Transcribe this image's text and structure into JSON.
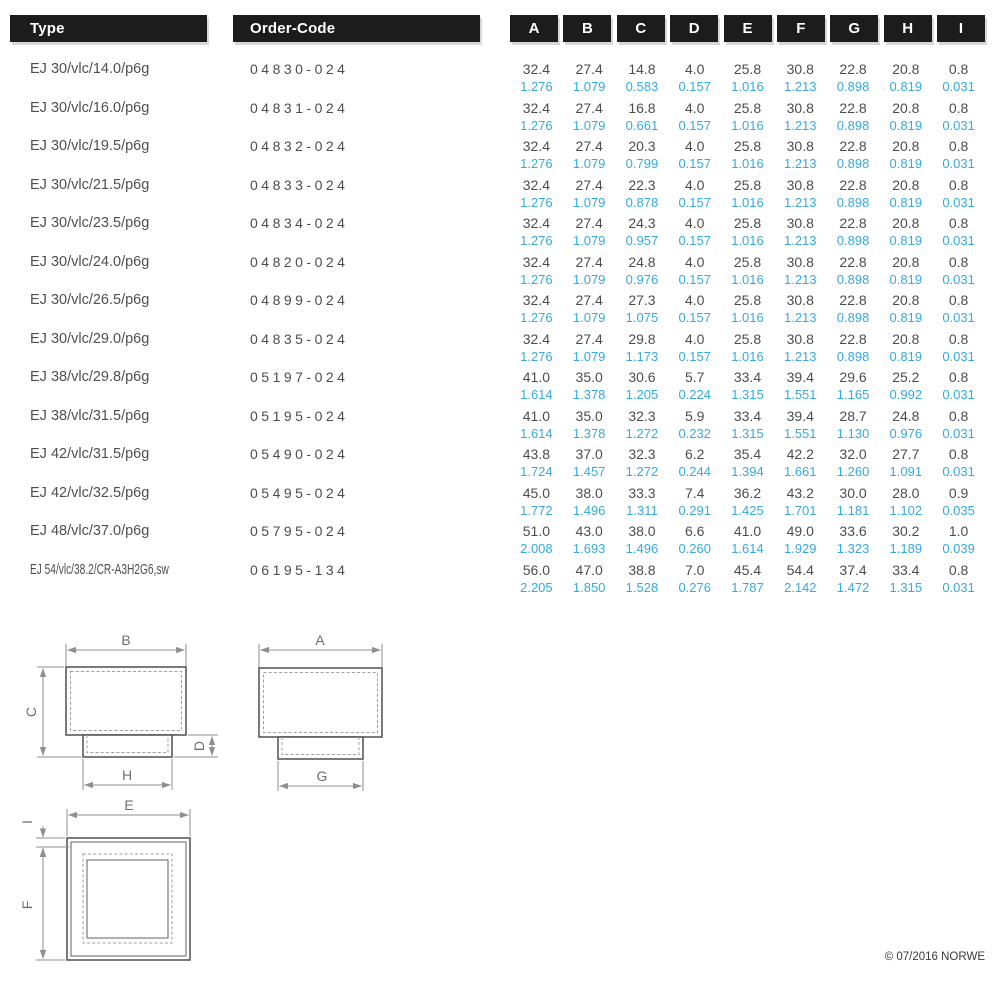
{
  "header": {
    "type_label": "Type",
    "order_code_label": "Order-Code",
    "dim_columns": [
      "A",
      "B",
      "C",
      "D",
      "E",
      "F",
      "G",
      "H",
      "I"
    ]
  },
  "rows": [
    {
      "type": "EJ 30/vlc/14.0/p6g",
      "order_code": "04830-024",
      "mm": [
        "32.4",
        "27.4",
        "14.8",
        "4.0",
        "25.8",
        "30.8",
        "22.8",
        "20.8",
        "0.8"
      ],
      "inch": [
        "1.276",
        "1.079",
        "0.583",
        "0.157",
        "1.016",
        "1.213",
        "0.898",
        "0.819",
        "0.031"
      ]
    },
    {
      "type": "EJ 30/vlc/16.0/p6g",
      "order_code": "04831-024",
      "mm": [
        "32.4",
        "27.4",
        "16.8",
        "4.0",
        "25.8",
        "30.8",
        "22.8",
        "20.8",
        "0.8"
      ],
      "inch": [
        "1.276",
        "1.079",
        "0.661",
        "0.157",
        "1.016",
        "1.213",
        "0.898",
        "0.819",
        "0.031"
      ]
    },
    {
      "type": "EJ 30/vlc/19.5/p6g",
      "order_code": "04832-024",
      "mm": [
        "32.4",
        "27.4",
        "20.3",
        "4.0",
        "25.8",
        "30.8",
        "22.8",
        "20.8",
        "0.8"
      ],
      "inch": [
        "1.276",
        "1.079",
        "0.799",
        "0.157",
        "1.016",
        "1.213",
        "0.898",
        "0.819",
        "0.031"
      ]
    },
    {
      "type": "EJ 30/vlc/21.5/p6g",
      "order_code": "04833-024",
      "mm": [
        "32.4",
        "27.4",
        "22.3",
        "4.0",
        "25.8",
        "30.8",
        "22.8",
        "20.8",
        "0.8"
      ],
      "inch": [
        "1.276",
        "1.079",
        "0.878",
        "0.157",
        "1.016",
        "1.213",
        "0.898",
        "0.819",
        "0.031"
      ]
    },
    {
      "type": "EJ 30/vlc/23.5/p6g",
      "order_code": "04834-024",
      "mm": [
        "32.4",
        "27.4",
        "24.3",
        "4.0",
        "25.8",
        "30.8",
        "22.8",
        "20.8",
        "0.8"
      ],
      "inch": [
        "1.276",
        "1.079",
        "0.957",
        "0.157",
        "1.016",
        "1.213",
        "0.898",
        "0.819",
        "0.031"
      ]
    },
    {
      "type": "EJ 30/vlc/24.0/p6g",
      "order_code": "04820-024",
      "mm": [
        "32.4",
        "27.4",
        "24.8",
        "4.0",
        "25.8",
        "30.8",
        "22.8",
        "20.8",
        "0.8"
      ],
      "inch": [
        "1.276",
        "1.079",
        "0.976",
        "0.157",
        "1.016",
        "1.213",
        "0.898",
        "0.819",
        "0.031"
      ]
    },
    {
      "type": "EJ 30/vlc/26.5/p6g",
      "order_code": "04899-024",
      "mm": [
        "32.4",
        "27.4",
        "27.3",
        "4.0",
        "25.8",
        "30.8",
        "22.8",
        "20.8",
        "0.8"
      ],
      "inch": [
        "1.276",
        "1.079",
        "1.075",
        "0.157",
        "1.016",
        "1.213",
        "0.898",
        "0.819",
        "0.031"
      ]
    },
    {
      "type": "EJ 30/vlc/29.0/p6g",
      "order_code": "04835-024",
      "mm": [
        "32.4",
        "27.4",
        "29.8",
        "4.0",
        "25.8",
        "30.8",
        "22.8",
        "20.8",
        "0.8"
      ],
      "inch": [
        "1.276",
        "1.079",
        "1.173",
        "0.157",
        "1.016",
        "1.213",
        "0.898",
        "0.819",
        "0.031"
      ]
    },
    {
      "type": "EJ 38/vlc/29.8/p6g",
      "order_code": "05197-024",
      "mm": [
        "41.0",
        "35.0",
        "30.6",
        "5.7",
        "33.4",
        "39.4",
        "29.6",
        "25.2",
        "0.8"
      ],
      "inch": [
        "1.614",
        "1.378",
        "1.205",
        "0.224",
        "1.315",
        "1.551",
        "1.165",
        "0.992",
        "0.031"
      ]
    },
    {
      "type": "EJ 38/vlc/31.5/p6g",
      "order_code": "05195-024",
      "mm": [
        "41.0",
        "35.0",
        "32.3",
        "5.9",
        "33.4",
        "39.4",
        "28.7",
        "24.8",
        "0.8"
      ],
      "inch": [
        "1.614",
        "1.378",
        "1.272",
        "0.232",
        "1.315",
        "1.551",
        "1.130",
        "0.976",
        "0.031"
      ]
    },
    {
      "type": "EJ 42/vlc/31.5/p6g",
      "order_code": "05490-024",
      "mm": [
        "43.8",
        "37.0",
        "32.3",
        "6.2",
        "35.4",
        "42.2",
        "32.0",
        "27.7",
        "0.8"
      ],
      "inch": [
        "1.724",
        "1.457",
        "1.272",
        "0.244",
        "1.394",
        "1.661",
        "1.260",
        "1.091",
        "0.031"
      ]
    },
    {
      "type": "EJ 42/vlc/32.5/p6g",
      "order_code": "05495-024",
      "mm": [
        "45.0",
        "38.0",
        "33.3",
        "7.4",
        "36.2",
        "43.2",
        "30.0",
        "28.0",
        "0.9"
      ],
      "inch": [
        "1.772",
        "1.496",
        "1.311",
        "0.291",
        "1.425",
        "1.701",
        "1.181",
        "1.102",
        "0.035"
      ]
    },
    {
      "type": "EJ 48/vlc/37.0/p6g",
      "order_code": "05795-024",
      "mm": [
        "51.0",
        "43.0",
        "38.0",
        "6.6",
        "41.0",
        "49.0",
        "33.6",
        "30.2",
        "1.0"
      ],
      "inch": [
        "2.008",
        "1.693",
        "1.496",
        "0.260",
        "1.614",
        "1.929",
        "1.323",
        "1.189",
        "0.039"
      ]
    },
    {
      "type": "EJ 54/vlc/38.2/CR-A3H2G6,sw",
      "order_code": "06195-134",
      "mm": [
        "56.0",
        "47.0",
        "38.8",
        "7.0",
        "45.4",
        "54.4",
        "37.4",
        "33.4",
        "0.8"
      ],
      "inch": [
        "2.205",
        "1.850",
        "1.528",
        "0.276",
        "1.787",
        "2.142",
        "1.472",
        "1.315",
        "0.031"
      ]
    }
  ],
  "diagrams": {
    "front_view": {
      "top": "B",
      "left": "C",
      "right": "D",
      "bottom": "H"
    },
    "side_view": {
      "top": "A",
      "bottom": "G"
    },
    "bottom_view": {
      "top": "E",
      "left_top": "I",
      "left": "F"
    }
  },
  "footer": {
    "copyright": "© 07/2016 NORWE"
  },
  "colors": {
    "header_bg": "#1c1c1c",
    "header_text": "#ffffff",
    "value_mm_text": "#4d4d4d",
    "value_inch_text": "#36a9e1",
    "drawing_line": "#8f8f8f"
  }
}
